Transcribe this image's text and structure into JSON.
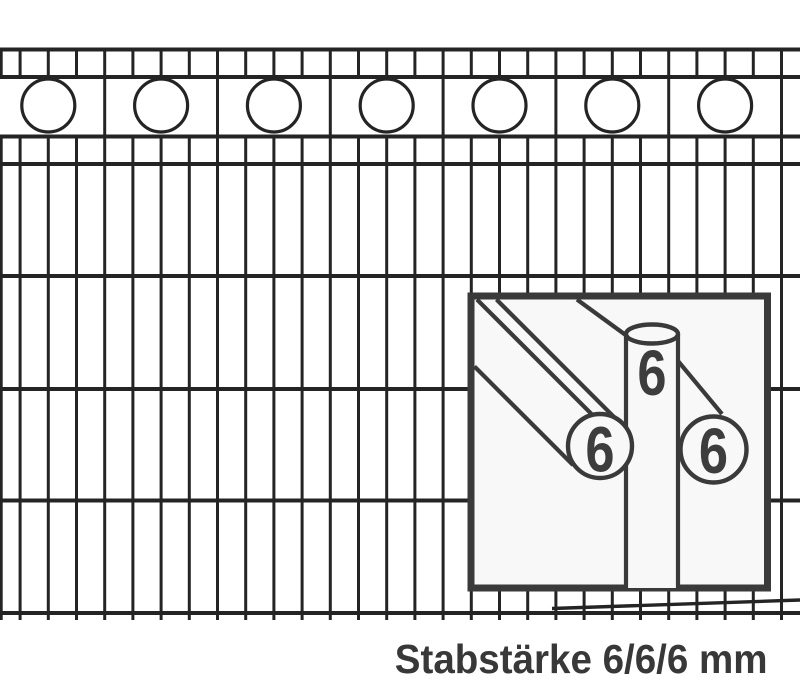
{
  "caption": {
    "text": "Stabstärke 6/6/6 mm"
  },
  "inset": {
    "labels": {
      "vertical_rod": "6",
      "front_horizontal_rod": "6",
      "back_horizontal_rod": "6"
    }
  },
  "colors": {
    "page_bg": "#ffffff",
    "fence_stroke": "#242424",
    "detail_stroke": "#3a3a3a",
    "label_color": "#3d3d3d",
    "caption_color": "#383838",
    "inset_bg": "#f8f8f8"
  }
}
